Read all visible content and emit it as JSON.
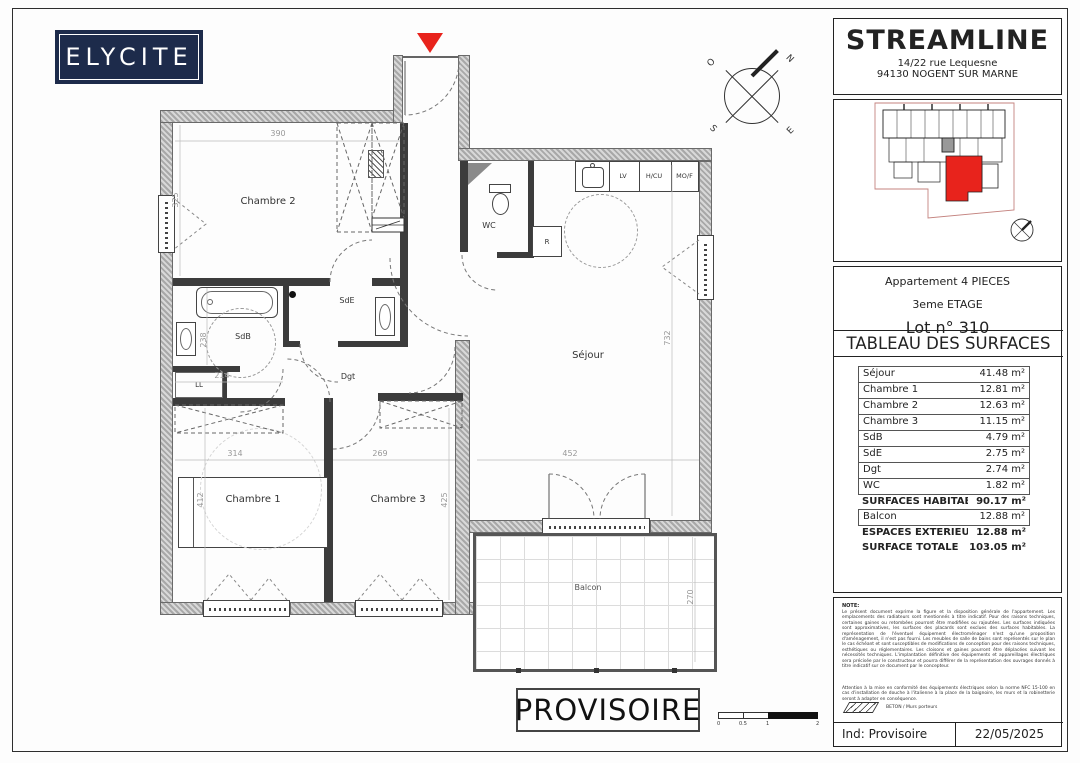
{
  "sheet": {
    "logo": "ELYCITE",
    "stamp": "PROVISOIRE",
    "scale_ticks": [
      "0",
      "0.5",
      "1",
      "2"
    ],
    "compass": {
      "n": "N",
      "e": "E",
      "s": "S",
      "o": "O"
    }
  },
  "plan": {
    "labels": {
      "chambre2": "Chambre 2",
      "wc": "WC",
      "lv": "LV",
      "hcu": "H/CU",
      "mof": "MO/F",
      "r": "R",
      "sdb": "SdB",
      "sde": "SdE",
      "dgt": "Dgt",
      "ll": "LL",
      "sejour": "Séjour",
      "chambre1": "Chambre 1",
      "chambre3": "Chambre 3",
      "balcon": "Balcon"
    },
    "dimensions": {
      "chambre2_width": "390",
      "chambre2_height": "325",
      "sdb_height": "238",
      "sdb_width": "214",
      "chambre1_width": "314",
      "chambre1_height": "412",
      "chambre3_width": "269",
      "chambre3_height": "425",
      "sejour_width": "452",
      "sejour_height": "732",
      "balcon_depth": "270"
    }
  },
  "title_block": {
    "brand": "STREAMLINE",
    "address_line1": "14/22 rue Lequesne",
    "address_line2": "94130 NOGENT SUR MARNE",
    "apartment_type": "Appartement 4 PIECES",
    "floor": "3eme ETAGE",
    "lot": "Lot n° 310",
    "table_title": "TABLEAU DES SURFACES",
    "surface_rows": [
      {
        "label": "Séjour",
        "value": "41.48 m²"
      },
      {
        "label": "Chambre 1",
        "value": "12.81 m²"
      },
      {
        "label": "Chambre 2",
        "value": "12.63 m²"
      },
      {
        "label": "Chambre 3",
        "value": "11.15 m²"
      },
      {
        "label": "SdB",
        "value": "4.79 m²"
      },
      {
        "label": "SdE",
        "value": "2.75 m²"
      },
      {
        "label": "Dgt",
        "value": "2.74 m²"
      },
      {
        "label": "WC",
        "value": "1.82 m²"
      },
      {
        "label": "SURFACES HABITABLES",
        "value": "90.17 m²"
      },
      {
        "label": "Balcon",
        "value": "12.88 m²"
      },
      {
        "label": "ESPACES EXTERIEURS",
        "value": "12.88 m²"
      },
      {
        "label": "SURFACE TOTALE",
        "value": "103.05 m²"
      }
    ],
    "note_title": "NOTE:",
    "note_p1": "Le présent document exprime la figure et la disposition générale de l'appartement. Les emplacements des radiateurs sont mentionnés à titre indicatif. Pour des raisons techniques, certaines gaines ou retombées pourront être modifiées ou rajoutées. Les surfaces indiquées sont approximatives, les surfaces des placards sont exclues des surfaces habitables. La représentation de l'éventuel équipement électroménager n'est qu'une proposition d'aménagement, il n'est pas fourni. Les meubles de salle de bains sont représentés sur le plan le cas échéant et sont susceptibles de modifications de conception pour des raisons techniques, esthétiques ou réglementaires. Les cloisons et gaines pourront être déplacées suivant les nécessités techniques. L'implantation définitive des équipements et appareillages électriques sera précisée par le constructeur et pourra différer de la représentation des ouvrages donnés à titre indicatif sur ce document par le concepteur.",
    "note_p2": "Attention à la mise en conformité des équipements électriques selon la norme NFC 15-100 en cas d'installation de douche à l'italienne à la place de la baignoire, les murs et la robinetterie seront à adapter en conséquence.",
    "legend_masonry": "BETON / Murs porteurs",
    "index_label": "Ind: Provisoire",
    "date": "22/05/2025"
  },
  "colors": {
    "accent_red": "#e8231c",
    "logo_navy": "#1d2b4b",
    "wall_gray": "#b0b0b0"
  }
}
